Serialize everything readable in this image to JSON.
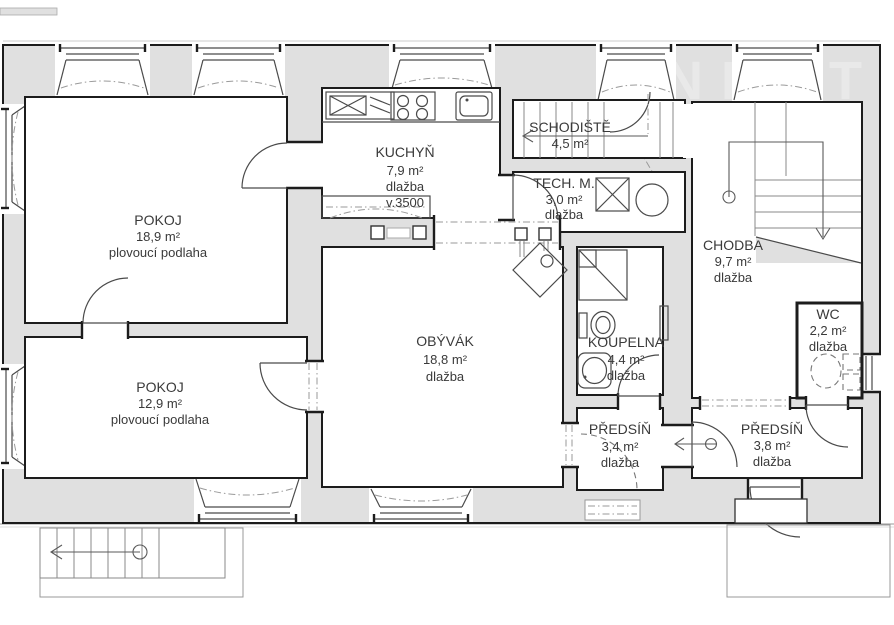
{
  "watermark": "NEXT",
  "rooms": [
    {
      "id": "pokoj-1",
      "name": "POKOJ",
      "area": "18,9 m²",
      "floor": "plovoucí podlaha"
    },
    {
      "id": "pokoj-2",
      "name": "POKOJ",
      "area": "12,9 m²",
      "floor": "plovoucí podlaha"
    },
    {
      "id": "kuchyn",
      "name": "KUCHYŇ",
      "area": "7,9 m²",
      "floor": "dlažba",
      "height": "v.3500"
    },
    {
      "id": "schodiste",
      "name": "SCHODIŠTĚ",
      "area": "4,5 m²"
    },
    {
      "id": "tech-m",
      "name": "TECH. M.",
      "area": "3,0 m²",
      "floor": "dlažba"
    },
    {
      "id": "obyvak",
      "name": "OBÝVÁK",
      "area": "18,8 m²",
      "floor": "dlažba"
    },
    {
      "id": "chodba",
      "name": "CHODBA",
      "area": "9,7 m²",
      "floor": "dlažba"
    },
    {
      "id": "koupelna",
      "name": "KOUPELNA",
      "area": "4,4 m²",
      "floor": "dlažba"
    },
    {
      "id": "wc",
      "name": "WC",
      "area": "2,2 m²",
      "floor": "dlažba"
    },
    {
      "id": "predsin-1",
      "name": "PŘEDSÍŇ",
      "area": "3,4 m²",
      "floor": "dlažba"
    },
    {
      "id": "predsin-2",
      "name": "PŘEDSÍŇ",
      "area": "3,8 m²",
      "floor": "dlažba"
    }
  ],
  "colors": {
    "wall_fill": "#e0e0e0",
    "wall_line": "#1c1c1c",
    "room_fill": "#ffffff",
    "fixture_line": "#4a4a4a",
    "dash_line": "#9a9a9a",
    "text": "#3a3a3a",
    "watermark": "#e9e9e9"
  }
}
